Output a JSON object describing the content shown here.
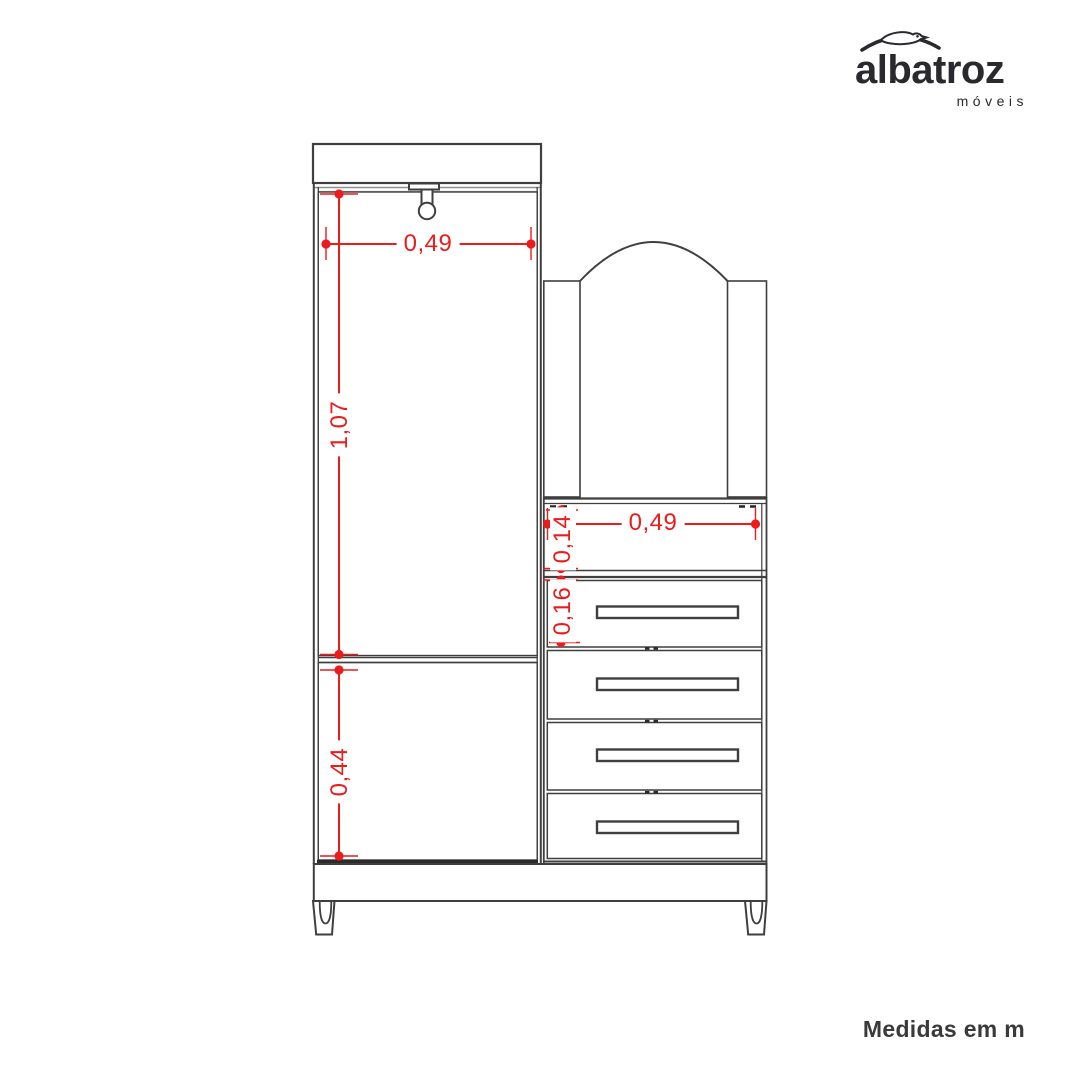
{
  "logo": {
    "brand": "albatroz",
    "subtitle": "móveis"
  },
  "note": {
    "units": "Medidas em m"
  },
  "colors": {
    "dimension_red": "#ea1c1c",
    "outline_dark": "#3f3f3f",
    "outline_heavy": "#2b2b2b",
    "detail_gray": "#8f8f8f",
    "logo_ink": "#2a2a2e",
    "note_text": "#3a3a3a"
  },
  "dimensions": {
    "wardrobe_width": "0,49",
    "door_height": "1,07",
    "lower_door_height": "0,44",
    "chest_width": "0,49",
    "shelf_gap_height": "0,14",
    "drawer_height": "0,16"
  }
}
